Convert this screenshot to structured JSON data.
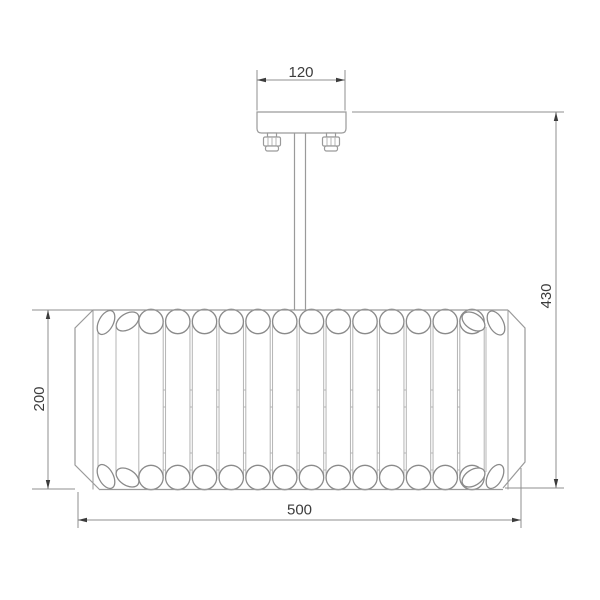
{
  "drawing": {
    "subject": "ceiling-chandelier-dimension-drawing",
    "dimensions": {
      "canopy_width": "120",
      "overall_height": "430",
      "shade_height": "200",
      "shade_width": "500"
    },
    "fixture": {
      "front_tube_count": 13,
      "left_edge_tube_count": 2,
      "right_edge_tube_count": 2,
      "mounting_screw_count": 2
    },
    "colors": {
      "outline": "#9a9a9a",
      "light_line": "#b4b4b4",
      "cap_stroke": "#8a8a8a",
      "dimension_line": "#8f8f8f",
      "text": "#3c3c3c",
      "background": "#ffffff"
    }
  }
}
